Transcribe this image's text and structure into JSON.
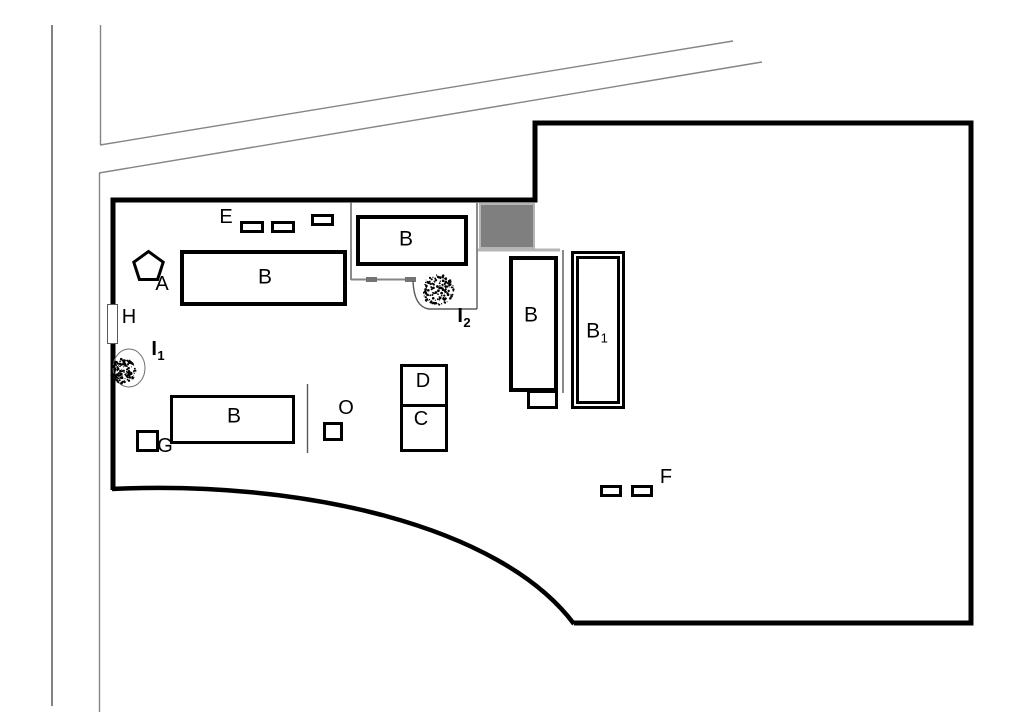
{
  "diagram": {
    "kind": "site-plan-sketch",
    "colors": {
      "outline": "#000000",
      "road_dark": "#4d4d4d",
      "road_gray": "#858585",
      "thin_line": "#595959",
      "tick": "#737373",
      "light_line": "#b5b5b5",
      "gray_block_fill": "#7f7f7f",
      "gray_block_border": "#b5b5b5",
      "label": "#000000"
    },
    "labels": {
      "A": {
        "text": "A"
      },
      "B_main": {
        "text": "B"
      },
      "B_top": {
        "text": "B"
      },
      "B_right": {
        "text": "B"
      },
      "B1": {
        "text": "B",
        "sub": "1"
      },
      "B_lower": {
        "text": "B"
      },
      "C": {
        "text": "C"
      },
      "D": {
        "text": "D"
      },
      "E": {
        "text": "E"
      },
      "F": {
        "text": "F"
      },
      "G": {
        "text": "G"
      },
      "H": {
        "text": "H"
      },
      "I1": {
        "text": "I",
        "sub": "1"
      },
      "I2": {
        "text": "I",
        "sub": "2"
      },
      "O": {
        "text": "O"
      }
    },
    "trees": [
      {
        "name": "tree-I1",
        "cx": 123,
        "cy": 371,
        "r": 13
      },
      {
        "name": "tree-I2",
        "cx": 438,
        "cy": 290,
        "r": 16
      }
    ]
  }
}
